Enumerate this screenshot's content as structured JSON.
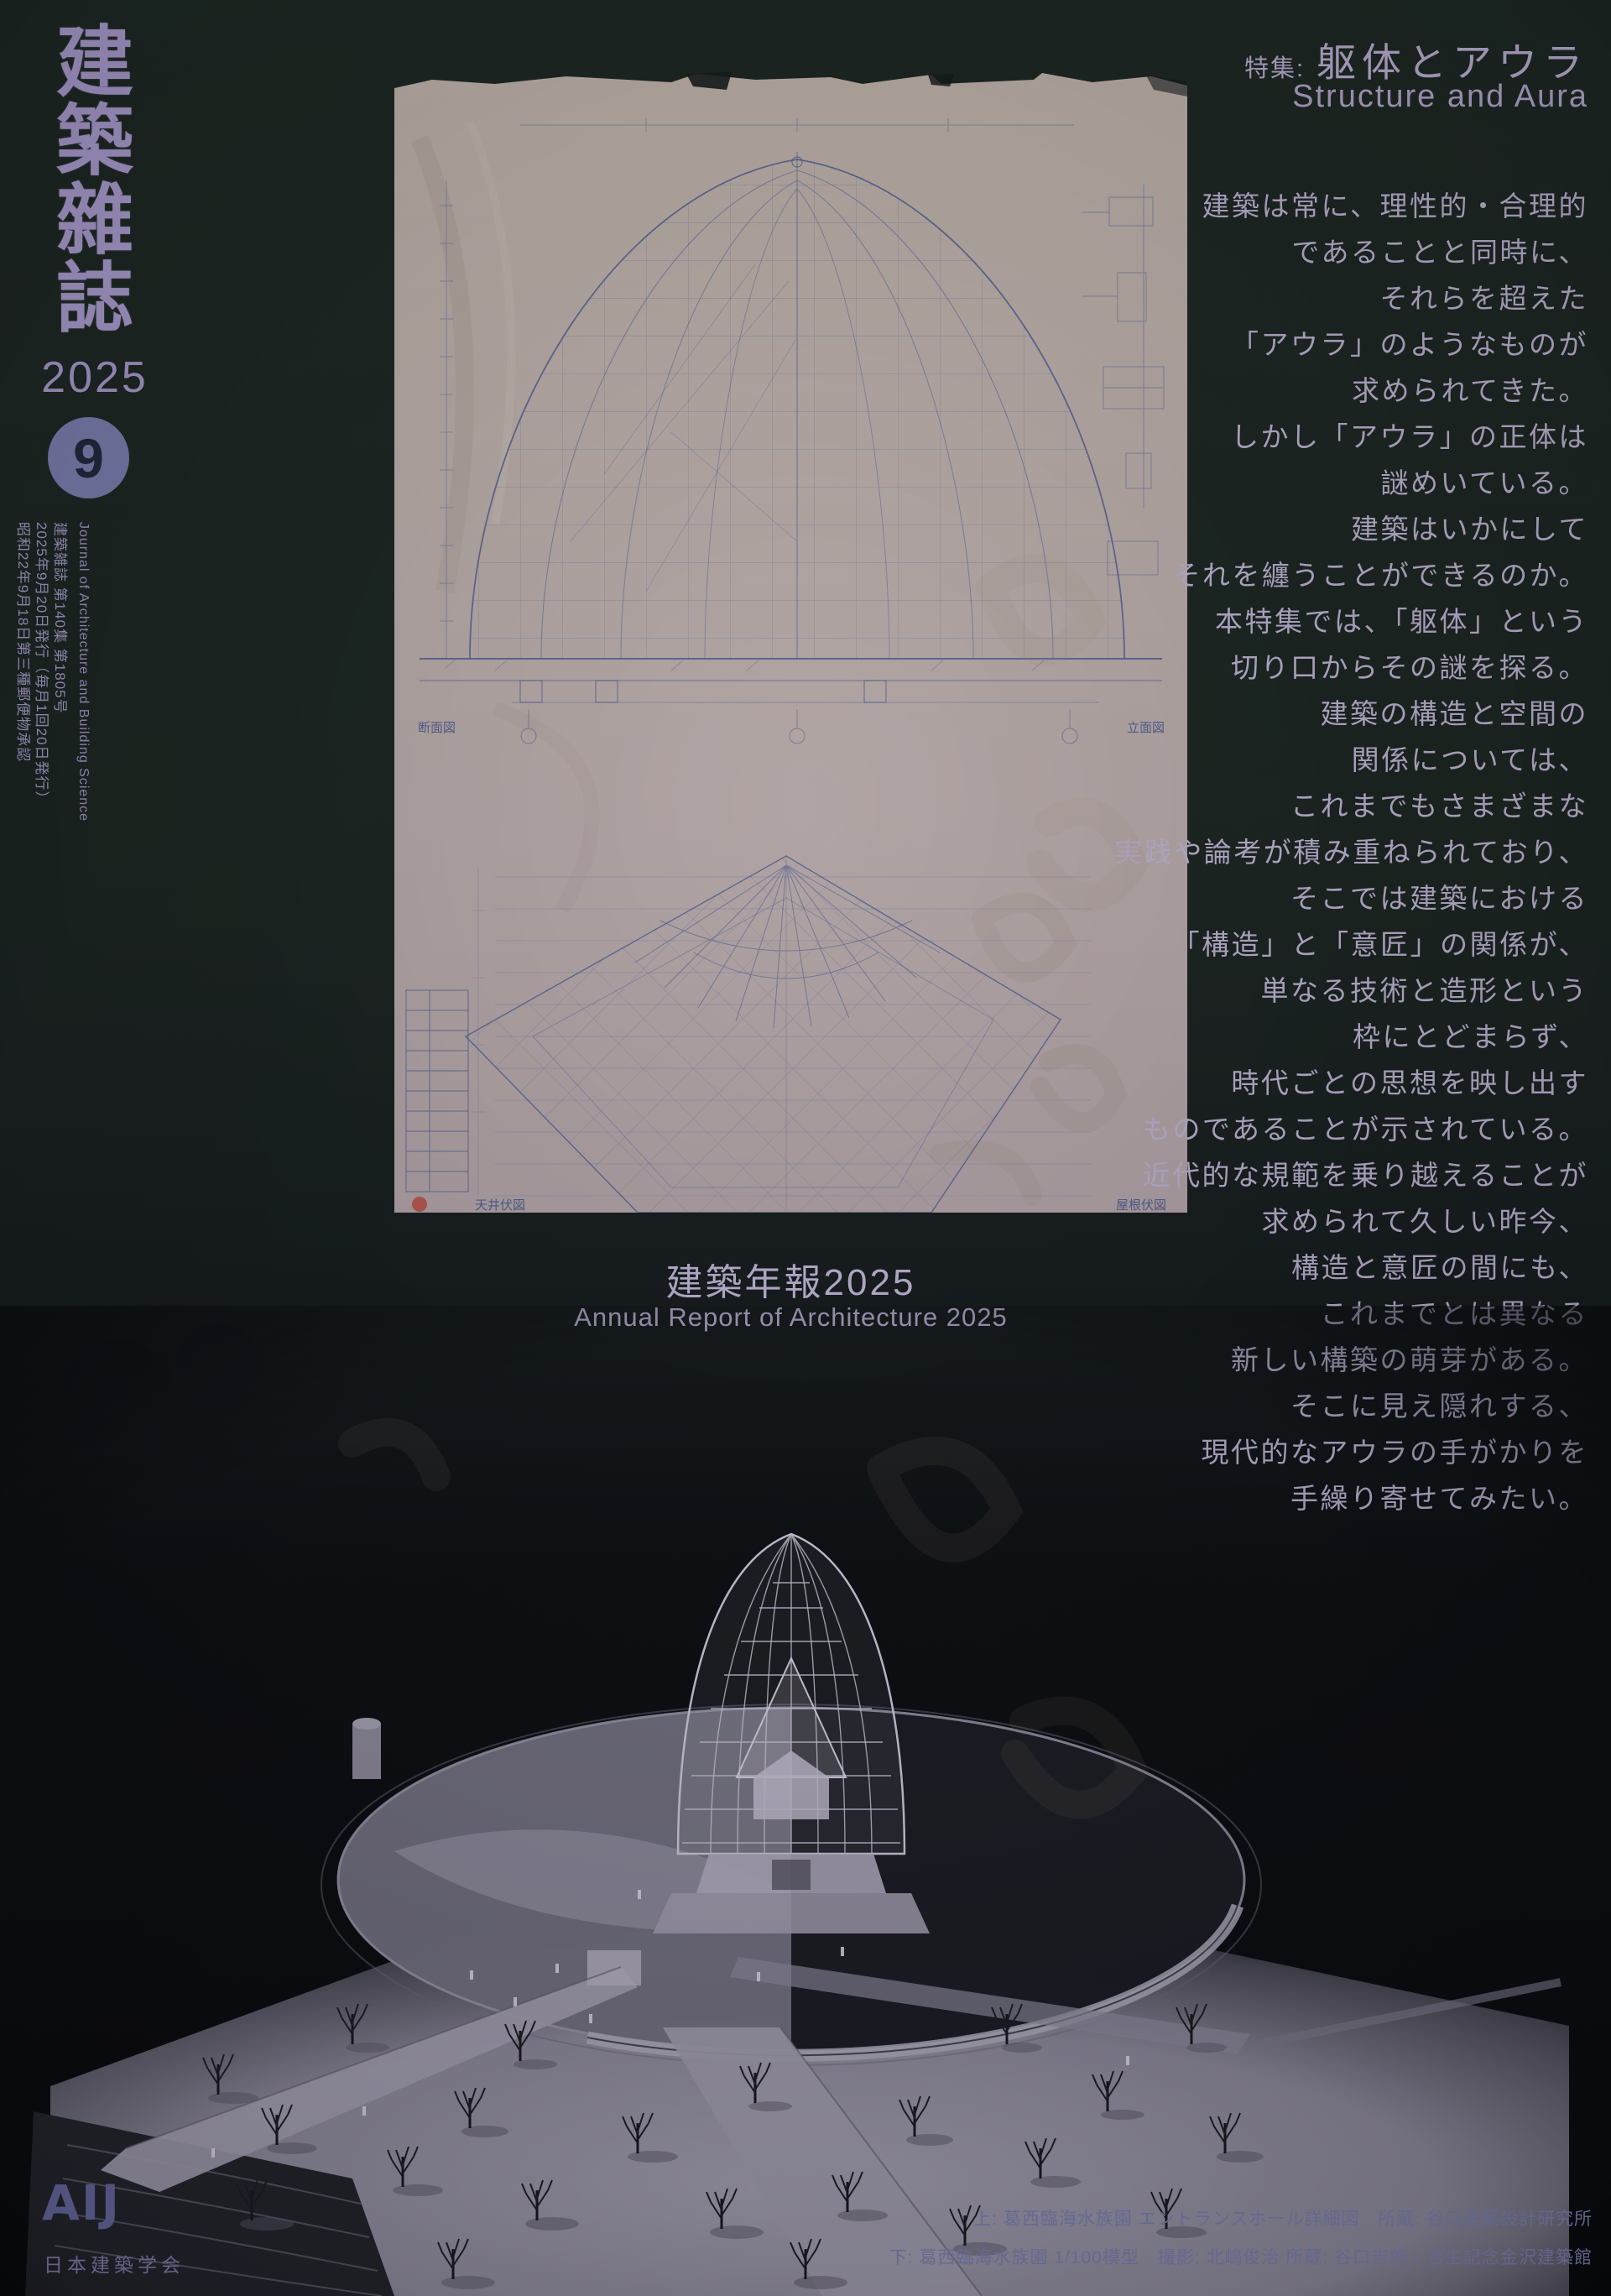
{
  "masthead": {
    "title_chars": [
      "建",
      "築",
      "雜",
      "誌"
    ],
    "year": "2025",
    "issue_number": "9",
    "pub_lines": [
      "Journal of Architecture and Building Science",
      "建築雑誌 第140集 第1805号",
      "2025年9月20日発行（毎月1回20日発行）",
      "昭和22年9月18日第三種郵便物承認"
    ]
  },
  "feature": {
    "label": "特集:",
    "title_jp": "躯体とアウラ",
    "title_en": "Structure and Aura",
    "body_lines": [
      "建築は常に、理性的・合理的",
      "であることと同時に、",
      "それらを超えた",
      "「アウラ」のようなものが",
      "求められてきた。",
      "しかし「アウラ」の正体は",
      "謎めいている。",
      "建築はいかにして",
      "それを纏うことができるのか。",
      "本特集では、「躯体」という",
      "切り口からその謎を探る。",
      "建築の構造と空間の",
      "関係については、",
      "これまでもさまざまな",
      "実践や論考が積み重ねられており、",
      "そこでは建築における",
      "「構造」と「意匠」の関係が、",
      "単なる技術と造形という",
      "枠にとどまらず、",
      "時代ごとの思想を映し出す",
      "ものであることが示されている。",
      "近代的な規範を乗り越えることが",
      "求められて久しい昨今、",
      "構造と意匠の間にも、",
      "これまでとは異なる",
      "新しい構築の萌芽がある。",
      "そこに見え隠れする、",
      "現代的なアウラの手がかりを",
      "手繰り寄せてみたい。"
    ]
  },
  "annual_report": {
    "title_jp": "建築年報2025",
    "title_en": "Annual Report of Architecture 2025"
  },
  "blueprint_labels": {
    "section": "断面図",
    "elevation": "立面図",
    "ceiling_plan": "天井伏図",
    "roof_plan": "屋根伏図"
  },
  "credits": {
    "top": "上: 葛西臨海水族園 エントランスホール詳細図　所蔵: 谷口建築設計研究所",
    "bottom": "下: 葛西臨海水族園 1/100模型　撮影: 北嶋俊治 所蔵: 谷口吉郎・吉生記念金沢建築館"
  },
  "publisher": {
    "logo": "AIJ",
    "name": "日本建築学会"
  },
  "colors": {
    "cover_background": "#19221f",
    "masthead_purple": "#a295c6",
    "issue_circle_fill": "#7477a6",
    "issue_digit": "#1e2438",
    "feature_text": "#b3aac8",
    "credit_text": "#7b82b4",
    "blueprint_paper": "#b3a7a3",
    "blueprint_ink": "#5d6a99",
    "red_seal": "#b5413a",
    "model_lines": "#d0c9dd"
  }
}
